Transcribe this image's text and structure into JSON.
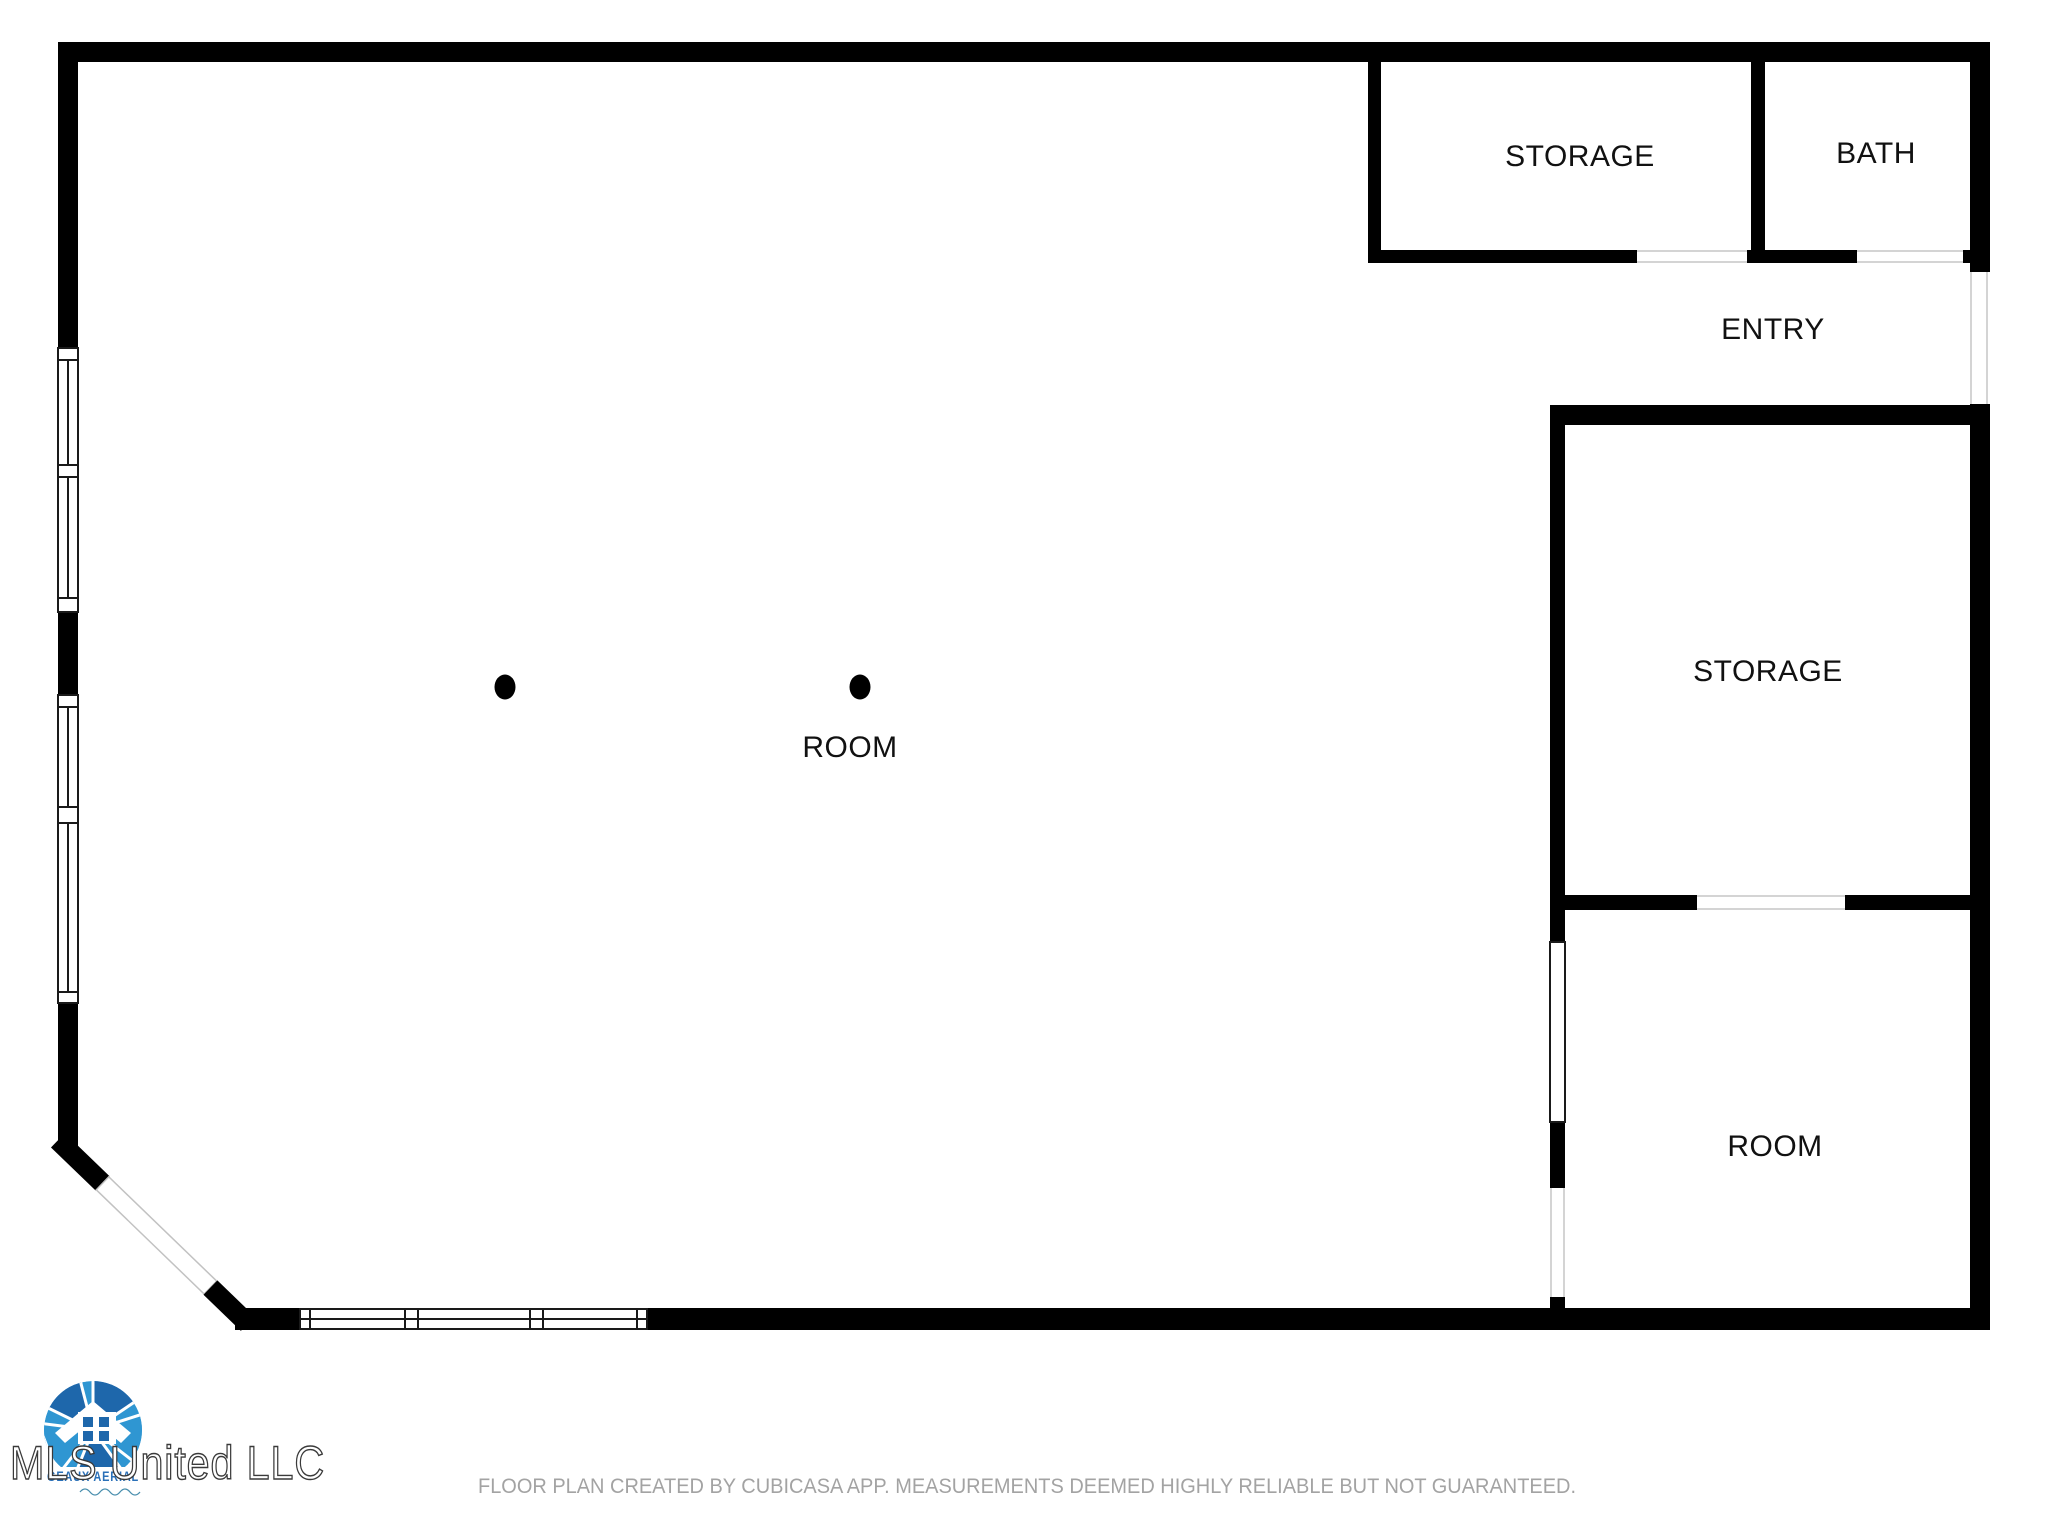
{
  "floorplan": {
    "wall_color": "#000000",
    "label_color": "#111111",
    "rooms": [
      {
        "id": "storage-top",
        "label": "STORAGE"
      },
      {
        "id": "bath",
        "label": "BATH"
      },
      {
        "id": "entry",
        "label": "ENTRY"
      },
      {
        "id": "storage-right",
        "label": "STORAGE"
      },
      {
        "id": "room-main",
        "label": "ROOM"
      },
      {
        "id": "room-lower",
        "label": "ROOM"
      }
    ],
    "column_dots": 2
  },
  "logo": {
    "company": "MLS United LLC",
    "brand": "GEAUX AERIAL",
    "blue_dark": "#1e67ab",
    "blue_light": "#2f96d2"
  },
  "footer": {
    "disclaimer": "FLOOR PLAN CREATED BY CUBICASA APP. MEASUREMENTS DEEMED HIGHLY RELIABLE BUT NOT GUARANTEED."
  }
}
